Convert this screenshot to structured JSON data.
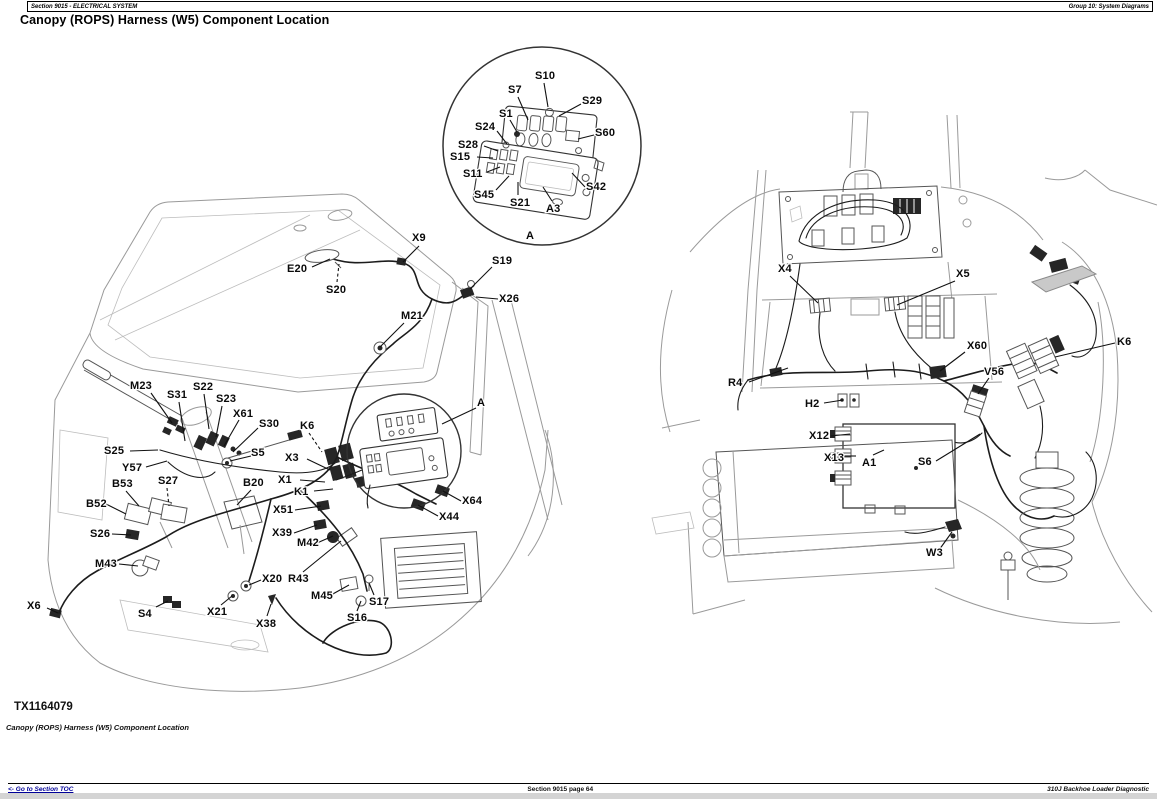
{
  "header": {
    "left": "Section 9015 - ELECTRICAL SYSTEM",
    "right": "Group 10: System Diagrams"
  },
  "title": "Canopy (ROPS) Harness (W5) Component Location",
  "figure": {
    "image_id": "TX1164079",
    "caption": "Canopy (ROPS) Harness (W5) Component Location",
    "detail_view_label": "A",
    "label_groups": [
      {
        "name": "inset-detail",
        "labels": [
          {
            "t": "S10",
            "x": 535,
            "y": 70,
            "l": [
              544,
              83,
              548,
              107
            ]
          },
          {
            "t": "S7",
            "x": 508,
            "y": 84,
            "l": [
              518,
              97,
              528,
              120
            ]
          },
          {
            "t": "S29",
            "x": 582,
            "y": 95,
            "l": [
              581,
              104,
              559,
              116
            ]
          },
          {
            "t": "S1",
            "x": 499,
            "y": 108,
            "l": [
              510,
              120,
              517,
              132
            ]
          },
          {
            "t": "S24",
            "x": 475,
            "y": 121,
            "l": [
              497,
              131,
              507,
              144
            ]
          },
          {
            "t": "S60",
            "x": 595,
            "y": 127,
            "l": [
              594,
              135,
              578,
              139
            ]
          },
          {
            "t": "S28",
            "x": 458,
            "y": 139,
            "l": [
              484,
              146,
              498,
              151
            ]
          },
          {
            "t": "S15",
            "x": 450,
            "y": 151,
            "l": [
              477,
              157,
              493,
              158
            ]
          },
          {
            "t": "S11",
            "x": 463,
            "y": 168,
            "l": [
              487,
              172,
              500,
              167
            ]
          },
          {
            "t": "S45",
            "x": 474,
            "y": 189,
            "l": [
              496,
              190,
              509,
              176
            ]
          },
          {
            "t": "S21",
            "x": 510,
            "y": 197,
            "l": [
              518,
              195,
              518,
              182
            ]
          },
          {
            "t": "A3",
            "x": 546,
            "y": 203,
            "l": [
              552,
              201,
              543,
              187
            ]
          },
          {
            "t": "S42",
            "x": 586,
            "y": 181,
            "l": [
              585,
              187,
              572,
              173
            ]
          },
          {
            "t": "A",
            "x": 526,
            "y": 230
          }
        ]
      },
      {
        "name": "left-diagram",
        "labels": [
          {
            "t": "X9",
            "x": 412,
            "y": 232,
            "l": [
              419,
              246,
              403,
              262
            ]
          },
          {
            "t": "E20",
            "x": 287,
            "y": 263,
            "l": [
              312,
              267,
              330,
              259
            ]
          },
          {
            "t": "S20",
            "x": 326,
            "y": 284,
            "l": [
              337,
              282,
              339,
              264
            ],
            "dash": 1
          },
          {
            "t": "S19",
            "x": 492,
            "y": 255,
            "l": [
              492,
              267,
              470,
              289
            ]
          },
          {
            "t": "X26",
            "x": 499,
            "y": 293,
            "l": [
              498,
              299,
              476,
              297
            ]
          },
          {
            "t": "M21",
            "x": 401,
            "y": 310,
            "l": [
              404,
              323,
              380,
              347
            ]
          },
          {
            "t": "M23",
            "x": 130,
            "y": 380,
            "l": [
              151,
              393,
              172,
              423
            ]
          },
          {
            "t": "S22",
            "x": 193,
            "y": 381,
            "l": [
              204,
              394,
              209,
              429
            ]
          },
          {
            "t": "S31",
            "x": 167,
            "y": 389,
            "l": [
              179,
              402,
              185,
              441
            ]
          },
          {
            "t": "S23",
            "x": 216,
            "y": 393,
            "l": [
              222,
              406,
              216,
              437
            ]
          },
          {
            "t": "X61",
            "x": 233,
            "y": 408,
            "l": [
              239,
              420,
              224,
              446
            ]
          },
          {
            "t": "S30",
            "x": 259,
            "y": 418,
            "l": [
              258,
              428,
              233,
              452
            ]
          },
          {
            "t": "K6",
            "x": 300,
            "y": 420,
            "l": [
              309,
              433,
              322,
              452
            ],
            "dash": 1
          },
          {
            "t": "S25",
            "x": 104,
            "y": 445,
            "l": [
              130,
              451,
              158,
              450
            ]
          },
          {
            "t": "S5",
            "x": 251,
            "y": 447,
            "l": [
              251,
              456,
              230,
              461
            ]
          },
          {
            "t": "X3",
            "x": 285,
            "y": 452,
            "l": [
              307,
              459,
              330,
              470
            ]
          },
          {
            "t": "Y57",
            "x": 122,
            "y": 462,
            "l": [
              146,
              467,
              167,
              461
            ]
          },
          {
            "t": "X1",
            "x": 278,
            "y": 474,
            "l": [
              300,
              480,
              325,
              482
            ]
          },
          {
            "t": "K1",
            "x": 294,
            "y": 486,
            "l": [
              314,
              491,
              333,
              489
            ]
          },
          {
            "t": "B53",
            "x": 112,
            "y": 478,
            "l": [
              126,
              491,
              139,
              506
            ]
          },
          {
            "t": "S27",
            "x": 158,
            "y": 475,
            "l": [
              167,
              488,
              169,
              506
            ],
            "dash": 1
          },
          {
            "t": "B20",
            "x": 243,
            "y": 477,
            "l": [
              251,
              490,
              237,
              505
            ]
          },
          {
            "t": "B52",
            "x": 86,
            "y": 498,
            "l": [
              106,
              504,
              126,
              514
            ]
          },
          {
            "t": "X51",
            "x": 273,
            "y": 504,
            "l": [
              295,
              510,
              321,
              506
            ]
          },
          {
            "t": "S26",
            "x": 90,
            "y": 528,
            "l": [
              112,
              534,
              131,
              535
            ]
          },
          {
            "t": "X39",
            "x": 272,
            "y": 527,
            "l": [
              294,
              533,
              317,
              525
            ]
          },
          {
            "t": "M42",
            "x": 297,
            "y": 537,
            "l": [
              317,
              543,
              333,
              536
            ]
          },
          {
            "t": "M43",
            "x": 95,
            "y": 558,
            "l": [
              119,
              564,
              138,
              566
            ]
          },
          {
            "t": "X20",
            "x": 262,
            "y": 573,
            "l": [
              261,
              580,
              249,
              585
            ]
          },
          {
            "t": "R43",
            "x": 288,
            "y": 573,
            "l": [
              303,
              572,
              341,
              541
            ]
          },
          {
            "t": "M45",
            "x": 311,
            "y": 590,
            "l": [
              331,
              595,
              349,
              585
            ]
          },
          {
            "t": "S17",
            "x": 369,
            "y": 596,
            "l": [
              374,
              595,
              369,
              583
            ]
          },
          {
            "t": "S16",
            "x": 347,
            "y": 612,
            "l": [
              357,
              611,
              361,
              601
            ]
          },
          {
            "t": "X6",
            "x": 27,
            "y": 600,
            "l": [
              47,
              608,
              58,
              613
            ]
          },
          {
            "t": "S4",
            "x": 138,
            "y": 608,
            "l": [
              156,
              607,
              168,
              601
            ]
          },
          {
            "t": "X21",
            "x": 207,
            "y": 606,
            "l": [
              221,
              605,
              232,
              596
            ]
          },
          {
            "t": "X38",
            "x": 256,
            "y": 618,
            "l": [
              267,
              616,
              271,
              604
            ]
          },
          {
            "t": "X64",
            "x": 462,
            "y": 495,
            "l": [
              461,
              501,
              443,
              491
            ]
          },
          {
            "t": "X44",
            "x": 439,
            "y": 511,
            "l": [
              438,
              516,
              418,
              505
            ]
          },
          {
            "t": "A",
            "x": 477,
            "y": 397,
            "l": [
              476,
              408,
              442,
              424
            ]
          }
        ]
      },
      {
        "name": "right-diagram",
        "labels": [
          {
            "t": "X4",
            "x": 778,
            "y": 263,
            "l": [
              790,
              276,
              818,
              303
            ]
          },
          {
            "t": "X5",
            "x": 956,
            "y": 268,
            "l": [
              955,
              281,
              897,
              305
            ]
          },
          {
            "t": "K6",
            "x": 1117,
            "y": 336,
            "l": [
              1115,
              343,
              1055,
              357
            ]
          },
          {
            "t": "X60",
            "x": 967,
            "y": 340,
            "l": [
              965,
              352,
              940,
              371
            ]
          },
          {
            "t": "V56",
            "x": 984,
            "y": 366,
            "l": [
              989,
              378,
              978,
              394
            ]
          },
          {
            "t": "R4",
            "x": 728,
            "y": 377,
            "l": [
              749,
              382,
              788,
              368
            ]
          },
          {
            "t": "H2",
            "x": 805,
            "y": 398,
            "l": [
              824,
              403,
              843,
              400
            ]
          },
          {
            "t": "X12",
            "x": 809,
            "y": 430,
            "l": [
              831,
              436,
              850,
              434
            ]
          },
          {
            "t": "X13",
            "x": 824,
            "y": 452,
            "l": [
              844,
              456,
              856,
              456
            ]
          },
          {
            "t": "A1",
            "x": 862,
            "y": 457,
            "l": [
              873,
              455,
              884,
              450
            ]
          },
          {
            "t": "S6",
            "x": 918,
            "y": 456,
            "l": [
              936,
              461,
              980,
              434
            ]
          },
          {
            "t": "W3",
            "x": 926,
            "y": 547,
            "l": [
              939,
              550,
              952,
              532
            ]
          }
        ]
      }
    ]
  },
  "footer": {
    "toc_link": "<- Go to Section TOC",
    "page_label": "Section 9015 page 64",
    "product": "310J Backhoe Loader Diagnostic"
  },
  "colors": {
    "link": "#000099",
    "text": "#000000",
    "bottom_bar": "#d4d4d4"
  }
}
